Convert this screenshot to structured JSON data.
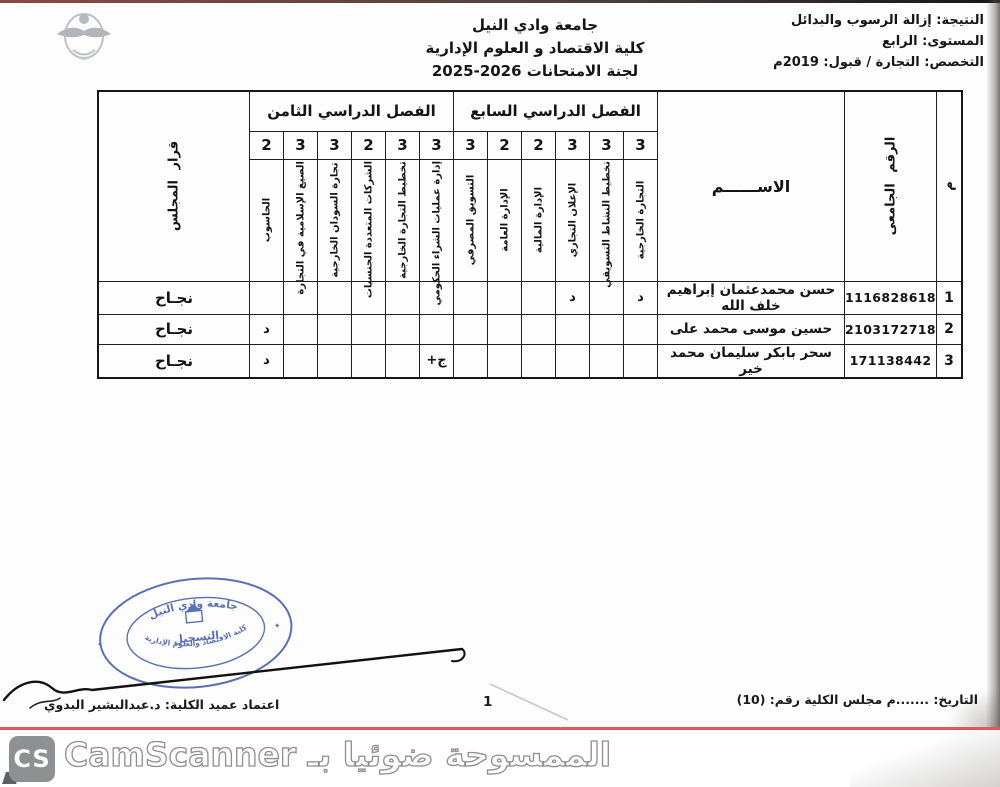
{
  "header": {
    "university": "جامعة وادي النيل",
    "college": "كلية الاقتصاد و العلوم الإدارية",
    "committee": "لجنة الامتحانات 2026-2025",
    "result_line": "النتيجة: إزالة الرسوب والبدائل",
    "level_line": "المستوى: الرابع",
    "major_line": "التخصص: التجارة / قبول: 2019م"
  },
  "table": {
    "serial_header": "م",
    "university_no_header": "الرقم الجامعى",
    "name_header": "الاســــــم",
    "semester7_header": "الفصل الدراسي السابع",
    "semester8_header": "الفصل الدراسي الثامن",
    "council_header": "قرار المجلس",
    "s7_courses": [
      {
        "name": "التجارة الخارجية",
        "hours": "3"
      },
      {
        "name": "تخطيط النشاط التسويقي",
        "hours": "3"
      },
      {
        "name": "الإعلان التجاري",
        "hours": "3"
      },
      {
        "name": "الإدارة المالية",
        "hours": "2"
      },
      {
        "name": "الإدارة العامة",
        "hours": "2"
      },
      {
        "name": "التسويق المصرفي",
        "hours": "3"
      }
    ],
    "s8_courses": [
      {
        "name": "إدارة عمليات الشراء الحكومي",
        "hours": "3"
      },
      {
        "name": "تخطيط التجارة الخارجية",
        "hours": "3"
      },
      {
        "name": "الشركات المتعددة الجنسيات",
        "hours": "2"
      },
      {
        "name": "تجارة السودان الخارجية",
        "hours": "3"
      },
      {
        "name": "الصيغ الإسلامية في التجارة",
        "hours": "3"
      },
      {
        "name": "الحاسوب",
        "hours": "2"
      }
    ],
    "students": [
      {
        "serial": "1",
        "university_no": "1116828618",
        "name": "حسن محمدعثمان إبراهيم خلف الله",
        "grades": [
          "د",
          "",
          "د",
          "",
          "",
          "",
          "",
          "",
          "",
          "",
          "",
          ""
        ],
        "council": "نجـاح"
      },
      {
        "serial": "2",
        "university_no": "2103172718",
        "name": "حسين موسى محمد على",
        "grades": [
          "",
          "",
          "",
          "",
          "",
          "",
          "",
          "",
          "",
          "",
          "",
          "د"
        ],
        "council": "نجـاح"
      },
      {
        "serial": "3",
        "university_no": "171138442",
        "name": "سحر بابكر سليمان محمد خير",
        "grades": [
          "",
          "",
          "",
          "",
          "",
          "",
          "ج+",
          "",
          "",
          "",
          "",
          "د"
        ],
        "council": "نجـاح"
      }
    ]
  },
  "stamp": {
    "top_text": "جامعة وادي النيل",
    "bottom_text": "كلية الاقتصاد والعلوم الإدارية",
    "center_text": "التسجيل"
  },
  "footer": {
    "date_line": "التاريخ:  .......م مجلس الكلية رقم: (10)",
    "page_number": "1",
    "dean_line": "اعتماد عميد الكلية: د.عبدالبشير البدوي"
  },
  "scanner": {
    "logo_text": "CS",
    "text": "الممسوحة ضوئيا بـ CamScanner"
  },
  "colors": {
    "stamp_blue": "#3f58a8",
    "footer_red": "#e0565e",
    "scanner_gray": "#8e9092",
    "ink": "#1a1a1a"
  }
}
